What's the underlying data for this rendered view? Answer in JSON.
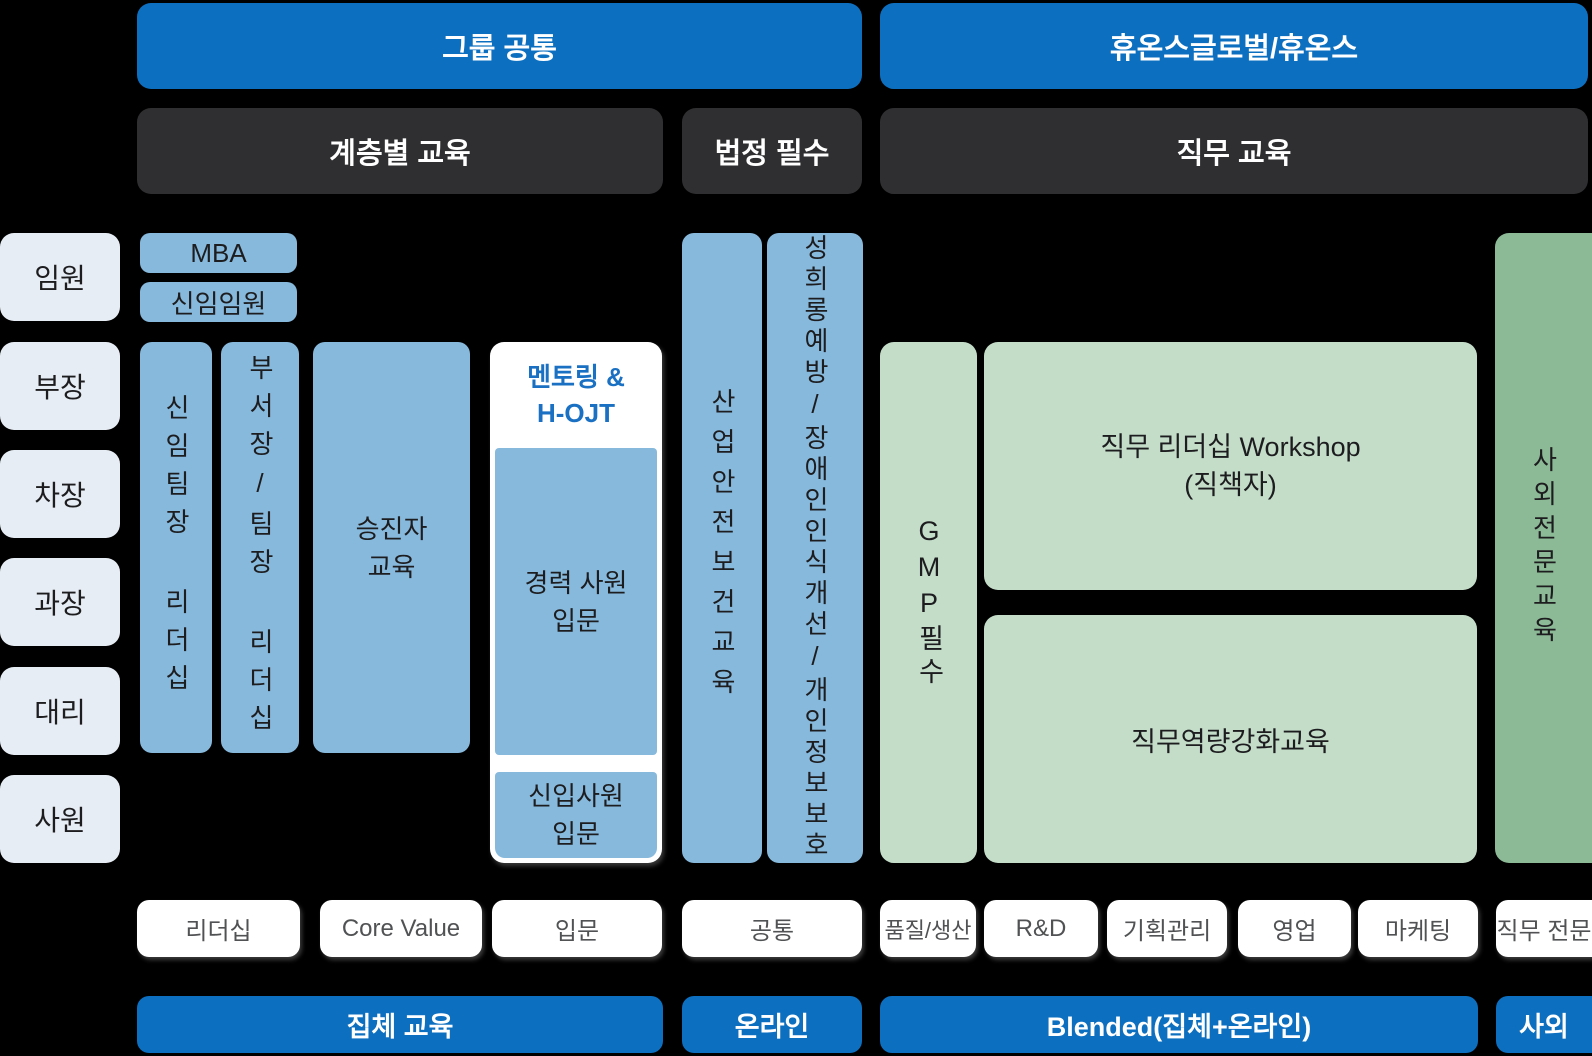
{
  "palette": {
    "bg": "#000000",
    "blue": "#0d6fbf",
    "dark": "#2f2f31",
    "lightblue": "#87b9dd",
    "rankbg": "#e7edf4",
    "green": "#c4ddc9",
    "darkgreen": "#8cb996",
    "accentblue": "#1a70c2",
    "pilltext": "#515254"
  },
  "headers": {
    "group_common": "그룹 공통",
    "huons": "휴온스글로벌/휴온스",
    "tier": "계층별 교육",
    "legal": "법정 필수",
    "job": "직무 교육"
  },
  "ranks": [
    "임원",
    "부장",
    "차장",
    "과장",
    "대리",
    "사원"
  ],
  "programs": {
    "mba": "MBA",
    "new_exec": "신임임원",
    "new_team_leader": "신임팀장 리더십",
    "dept_team_leader": "부서장/팀장 리더십",
    "promotee": [
      "승진자",
      "교육"
    ],
    "mentoring": [
      "멘토링 &",
      "H-OJT"
    ],
    "experienced": [
      "경력 사원",
      "입문"
    ],
    "newcomer": [
      "신입사원",
      "입문"
    ],
    "safety": "산업안전보건교육",
    "harassment": "성희롱예방/장애인인식개선/개인정보보호",
    "gmp": "GMP필수",
    "workshop": [
      "직무 리더십 Workshop",
      "(직책자)"
    ],
    "competency": "직무역량강화교육",
    "external": "사외전문교육"
  },
  "categories": [
    "리더십",
    "Core Value",
    "입문",
    "공통",
    "품질/생산",
    "R&D",
    "기획관리",
    "영업",
    "마케팅",
    "직무 전문"
  ],
  "methods": [
    "집체 교육",
    "온라인",
    "Blended(집체+온라인)",
    "사외"
  ]
}
